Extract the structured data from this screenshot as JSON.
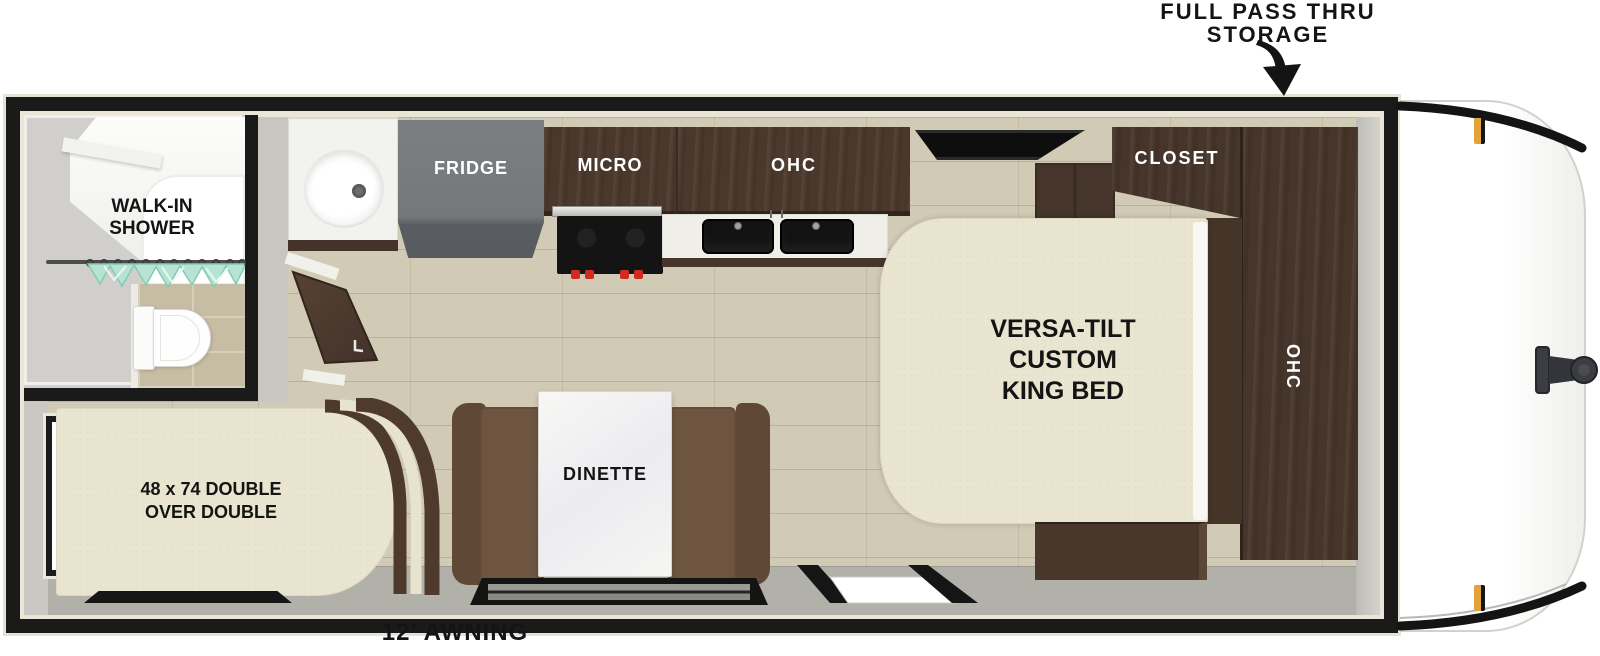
{
  "scene": {
    "type": "travel-trailer-floorplan"
  },
  "callouts": {
    "storage_lines": [
      "FULL PASS THRU",
      "STORAGE"
    ],
    "awning": "12’ AWNING"
  },
  "rooms": {
    "bathroom": {
      "shower_lines": [
        "WALK-IN",
        "SHOWER"
      ]
    },
    "bunk": {
      "label_lines": [
        "48 x 74 DOUBLE",
        "OVER DOUBLE"
      ]
    },
    "kitchen": {
      "fridge": "FRIDGE",
      "micro": "MICRO",
      "ohc": "OHC"
    },
    "bedroom": {
      "closet": "CLOSET",
      "ohc": "OHC",
      "bed_lines": [
        "VERSA-TILT",
        "CUSTOM",
        "KING BED"
      ]
    },
    "dinette": {
      "label": "DINETTE"
    }
  },
  "colors": {
    "wall": "#1a1a1a",
    "exterior_trim": "#e6e3d4",
    "wood_floor": "#d1cab4",
    "walkway_gray": "#b2b1a9",
    "cabinet_wood": "#4b382c",
    "mattress_cream": "#eae5d0",
    "dinette_seat_brown": "#6d5541",
    "fridge_gray": "#75797b",
    "table_white": "#f4f4f2",
    "curtain_teal": "#b7e3d4",
    "stove_black": "#141414",
    "knob_red": "#cf2b20",
    "sink_black": "#121212",
    "marker_light_amber": "#e2a33c",
    "hitch_gray": "#3c3d42"
  }
}
